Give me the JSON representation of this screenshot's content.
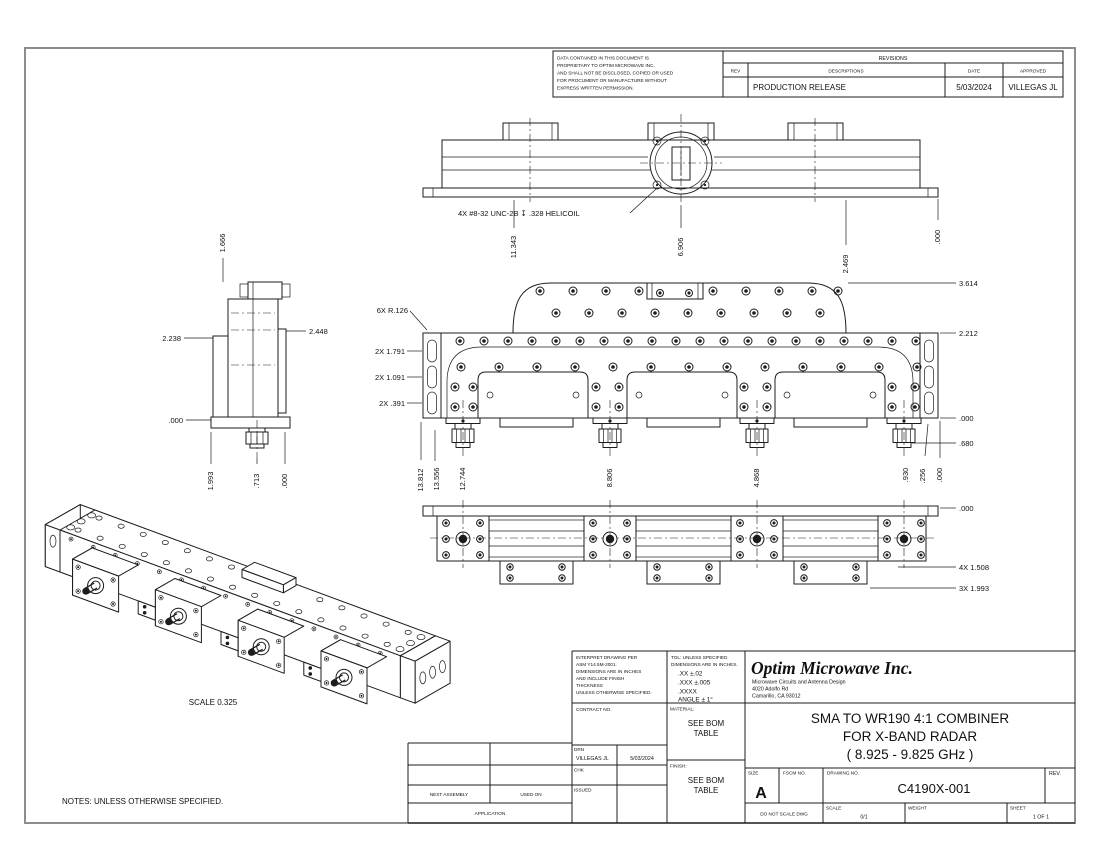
{
  "notes": "NOTES: UNLESS OTHERWISE SPECIFIED.",
  "iso_scale": "SCALE  0.325",
  "proprietary": {
    "lines": [
      "DATA CONTAINED IN THIS DOCUMENT IS",
      "PROPRIETARY TO OPTIM MICROWAVE INC.",
      "AND SHALL NOT BE DISCLOSED, COPIED OR USED",
      "FOR PROCUMENT OR MANUFACTURE WITHOUT",
      "EXPRESS WRITTEN PERMISSION."
    ]
  },
  "revisions": {
    "title": "REVISIONS",
    "headers": [
      "REV",
      "DESCRIPTIONS",
      "DATE",
      "APPROVED"
    ],
    "row": {
      "rev": "",
      "desc": "PRODUCTION RELEASE",
      "date": "5/03/2024",
      "approved": "VILLEGAS JL"
    }
  },
  "tb": {
    "interpret": [
      "INTERPRET DRAWING PER",
      "ASM Y14.5M-2001.",
      "DIMENSIONS ARE IN INCHES",
      "AND INCLUDE FINISH",
      "THICKNESS",
      "UNLESS OTHERWISE SPECIFIED."
    ],
    "tol": [
      "TOL: UNLESS SPECIFIED",
      "DIMENSIONS ARE IN INCHES.",
      ".XX  ±.02",
      ".XXX  ±.005",
      ".XXXX",
      "ANGLE ± 1°"
    ],
    "company": {
      "name": "Optim Microwave Inc.",
      "tagline": "Microwave Circuits and Antenna Design",
      "addr1": "4020 Adolfo Rd",
      "addr2": "Camarillo, CA 93012"
    },
    "contract": "CONTRACT NO.",
    "material_label": "MATERIAL:",
    "material": [
      "SEE BOM",
      "TABLE"
    ],
    "finish_label": "FINISH:",
    "finish": [
      "SEE BOM",
      "TABLE"
    ],
    "drn": "DRN",
    "drn_name": "VILLEGAS JL",
    "drn_date": "5/03/2024",
    "chk": "CHK",
    "issued": "ISSUED",
    "title": [
      "SMA TO WR190 4:1 COMBINER",
      "FOR X-BAND RADAR",
      "( 8.925 - 9.825 GHz )"
    ],
    "size_label": "SIZE",
    "size": "A",
    "fscm": "FSCM NO.",
    "dwg_label": "DRAWING NO.",
    "dwg_no": "C4190X-001",
    "rev": "REV.",
    "no_scale": "DO NOT SCALE DWG",
    "scale_label": "SCALE",
    "scale": "0/1",
    "weight": "WEIGHT",
    "sheet_label": "SHEET",
    "sheet": "1 OF 1",
    "next_assembly": "NEXT ASSEMBLY",
    "used_on": "USED ON",
    "application": "APPLICATION"
  },
  "dims": {
    "top_view": {
      "helicoil_note": "4X #8-32 UNC-2B ↧ .328 HELICOIL",
      "stations": [
        "11.343",
        "6.906",
        "2.469",
        ".000"
      ]
    },
    "front_view": {
      "left": [
        "6X R.126",
        "2X  1.791",
        "2X  1.091",
        "2X  .391"
      ],
      "right": [
        "3.614",
        "2.212",
        ".000",
        ".680"
      ],
      "bottom": [
        "13.812",
        "13.556",
        "12.744",
        "8.806",
        "4.868",
        ".930",
        ".256",
        ".000"
      ]
    },
    "bottom_view": {
      "right": [
        ".000",
        "4X  1.508",
        "3X  1.993"
      ]
    },
    "side_view": {
      "top": "1.666",
      "left": [
        "2.238",
        ".000"
      ],
      "right": "2.448",
      "bottom": [
        "1.993",
        ".713",
        ".000"
      ]
    }
  }
}
